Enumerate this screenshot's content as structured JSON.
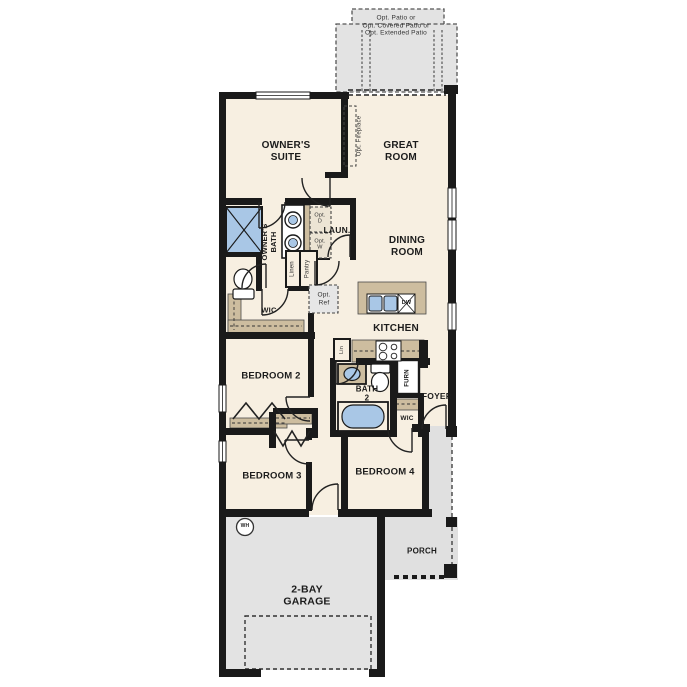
{
  "colors": {
    "wall": "#1a1a1a",
    "floor": "#f7efe1",
    "gray": "#e3e3e3",
    "cabinet": "#cdbd9f",
    "fixture_blue": "#a9c7e6"
  },
  "patio": {
    "label": "Opt. Patio or\nOpt. Covered Patio or\nOpt. Extended Patio"
  },
  "rooms": {
    "owners_suite": "OWNER'S\nSUITE",
    "great_room": "GREAT\nROOM",
    "owners_bath": "OWNER'S\nBATH",
    "laundry": "LAUN.",
    "dining_room": "DINING\nROOM",
    "kitchen": "KITCHEN",
    "owners_wic": "WIC",
    "bedroom2": "BEDROOM 2",
    "bath2": "BATH\n2",
    "foyer": "FOYER",
    "furnace": "FURN",
    "bedroom4_wic": "WIC",
    "bedroom3": "BEDROOM 3",
    "bedroom4": "BEDROOM 4",
    "porch": "PORCH",
    "garage": "2-BAY\nGARAGE"
  },
  "annotations": {
    "opt_fireplace": "Opt. Fireplace",
    "opt_dryer": "Opt.\nD",
    "opt_washer": "Opt.\nW",
    "linen": "Linen",
    "pantry": "Pantry",
    "opt_ref": "Opt.\nRef",
    "linen_small": "Lin",
    "dishwasher": "DW",
    "water_heater": "WH"
  }
}
